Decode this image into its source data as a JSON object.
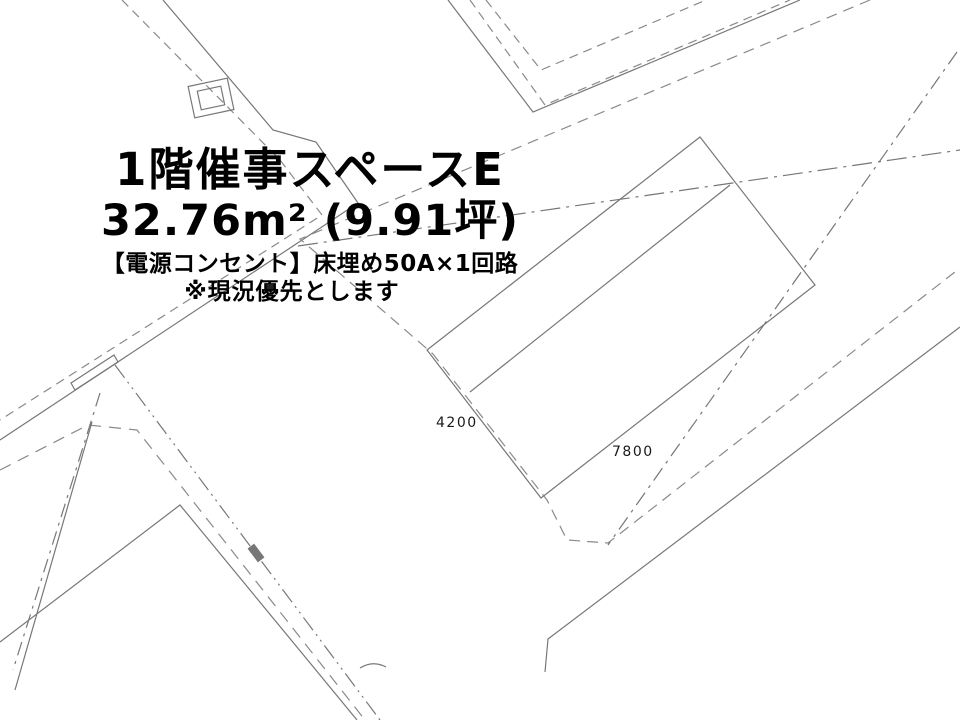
{
  "drawing": {
    "background_color": "#ffffff",
    "line_color": "#777777",
    "dashed_line_color": "#8a8a8a",
    "text_color": "#000000",
    "title": "1階催事スペースE",
    "area": "32.76m² (9.91坪)",
    "power_note": "【電源コンセント】床埋め50A×1回路",
    "caveat_note": "※現況優先とします",
    "dimensions": {
      "short_side_mm": "4200",
      "long_side_mm": "7800"
    }
  }
}
